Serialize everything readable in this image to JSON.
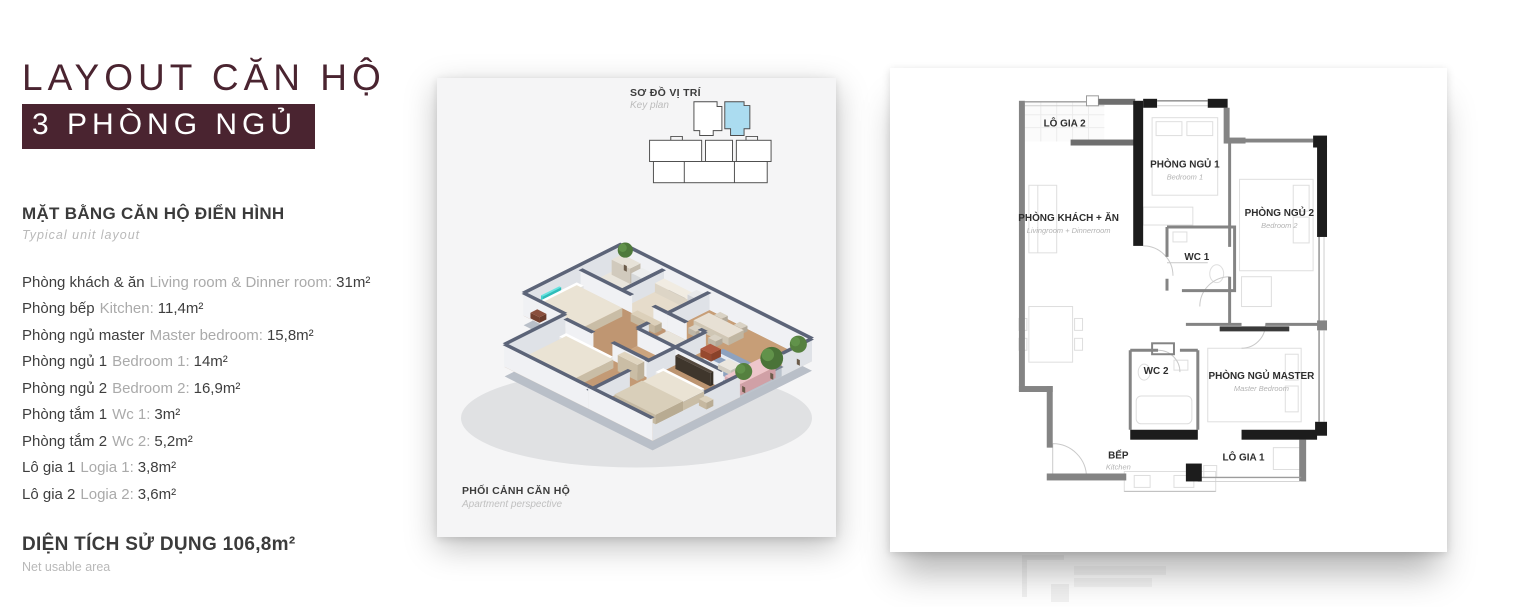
{
  "title": {
    "line1": "LAYOUT CĂN HỘ",
    "line2": "3 PHÒNG NGỦ"
  },
  "accent_color": "#4a2430",
  "specs": {
    "heading": "MẶT BẰNG CĂN HỘ ĐIỂN HÌNH",
    "subheading": "Typical unit layout",
    "rooms": [
      {
        "vi": "Phòng khách & ăn",
        "en": "Living room & Dinner room:",
        "area": "31m²"
      },
      {
        "vi": "Phòng bếp",
        "en": "Kitchen:",
        "area": "11,4m²"
      },
      {
        "vi": "Phòng ngủ master",
        "en": "Master bedroom:",
        "area": "15,8m²"
      },
      {
        "vi": "Phòng ngủ 1",
        "en": "Bedroom 1:",
        "area": "14m²"
      },
      {
        "vi": "Phòng ngủ 2",
        "en": "Bedroom 2:",
        "area": "16,9m²"
      },
      {
        "vi": "Phòng tắm 1",
        "en": "Wc 1:",
        "area": "3m²"
      },
      {
        "vi": "Phòng tắm 2",
        "en": "Wc 2:",
        "area": "5,2m²"
      },
      {
        "vi": "Lô gia 1",
        "en": "Logia 1:",
        "area": "3,8m²"
      },
      {
        "vi": "Lô gia 2",
        "en": "Logia 2:",
        "area": "3,6m²"
      }
    ],
    "total_label": "DIỆN TÍCH SỬ DỤNG 106,8m²",
    "total_sub": "Net usable area"
  },
  "perspective_card": {
    "keyplan_title": "SƠ ĐỒ VỊ TRÍ",
    "keyplan_sub": "Key plan",
    "keyplan_highlight_color": "#abdcf0",
    "caption_title": "PHỐI CẢNH CĂN HỘ",
    "caption_sub": "Apartment perspective"
  },
  "floorplan": {
    "rooms": [
      {
        "label": "LÔ GIA 2",
        "sub": ""
      },
      {
        "label": "PHÒNG NGỦ 1",
        "sub": "Bedroom 1"
      },
      {
        "label": "PHÒNG KHÁCH + ĂN",
        "sub": "Livingroom + Dinnerroom"
      },
      {
        "label": "PHÒNG NGỦ 2",
        "sub": "Bedroom 2"
      },
      {
        "label": "WC 1",
        "sub": ""
      },
      {
        "label": "WC 2",
        "sub": ""
      },
      {
        "label": "PHÒNG NGỦ MASTER",
        "sub": "Master Bedroom"
      },
      {
        "label": "BẾP",
        "sub": "Kitchen"
      },
      {
        "label": "LÔ GIA 1",
        "sub": ""
      }
    ]
  }
}
